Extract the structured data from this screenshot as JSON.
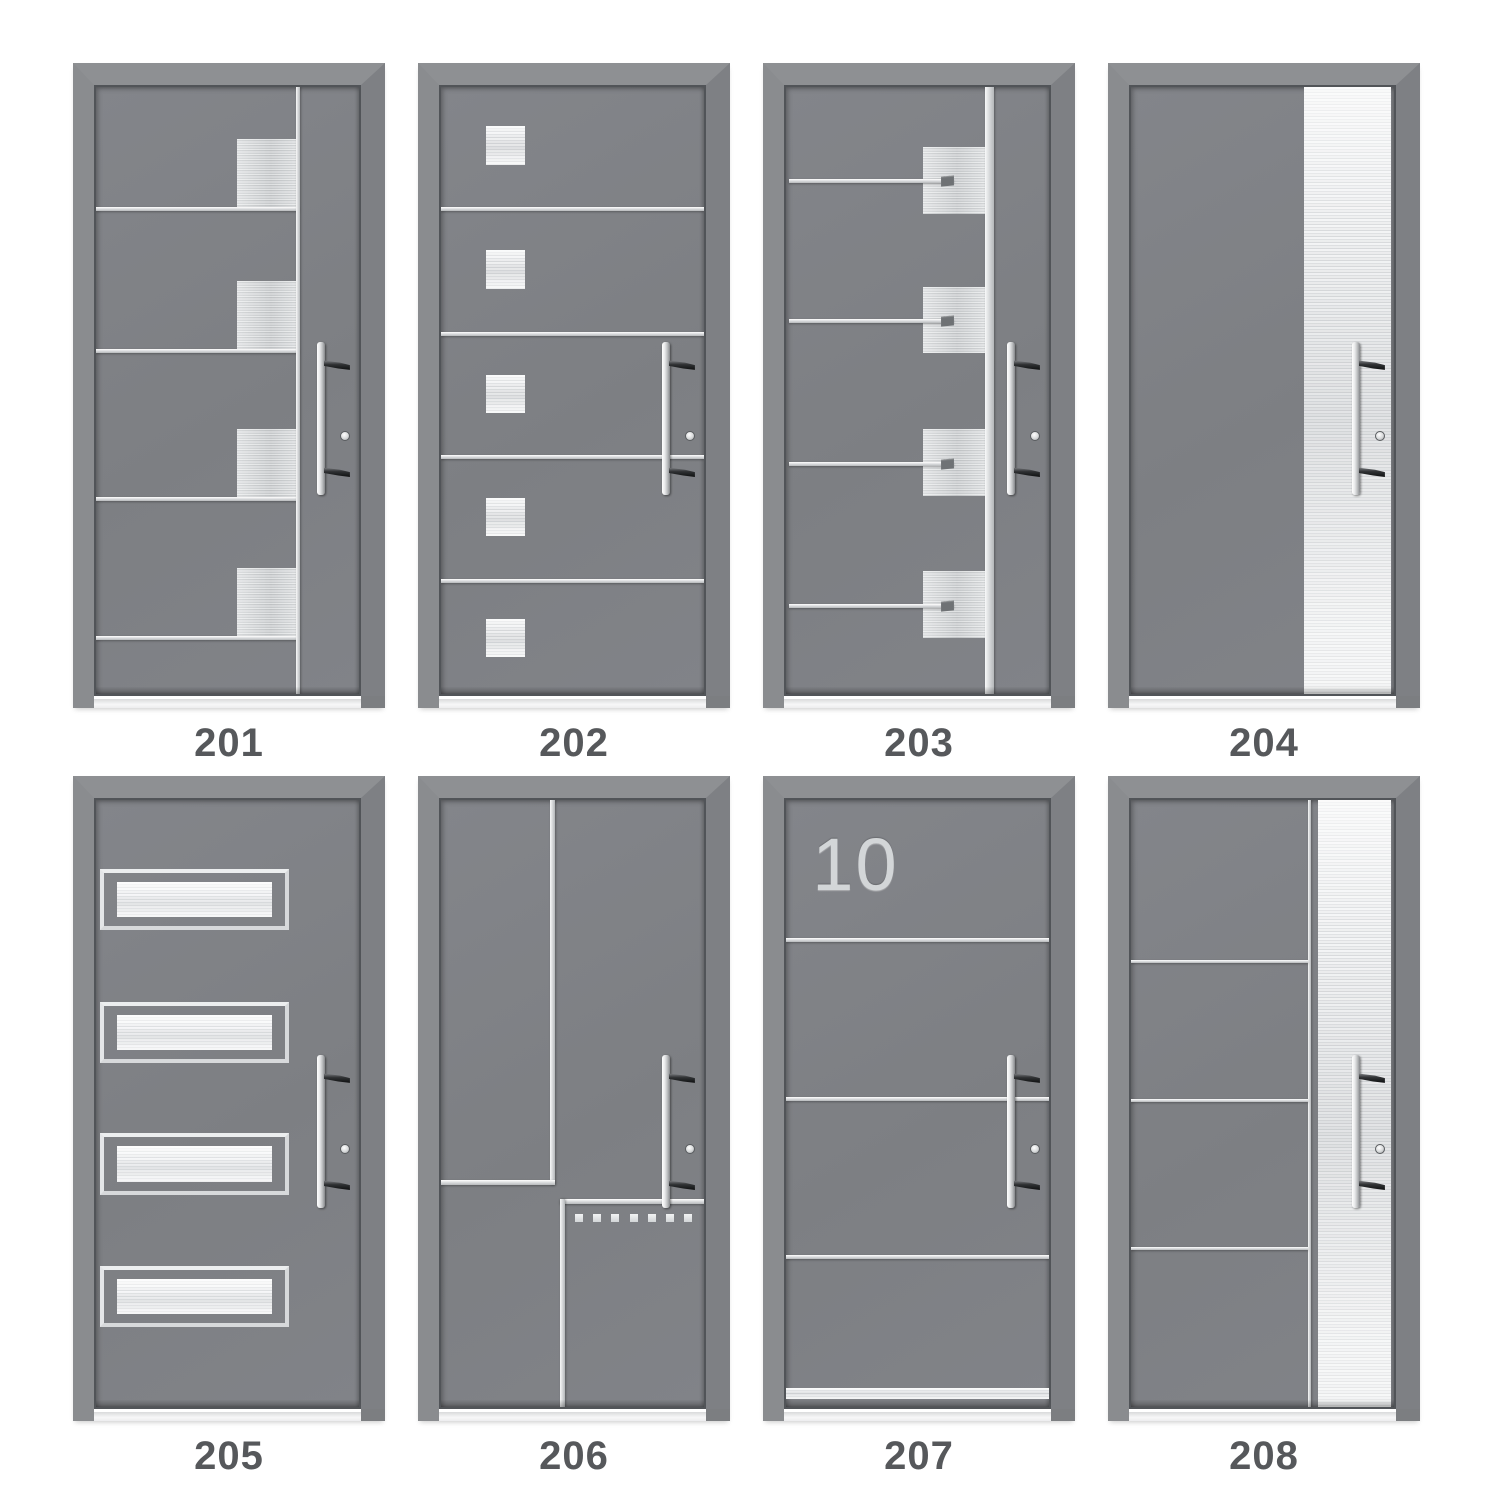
{
  "catalog": {
    "title": "entry-door-design-catalog",
    "doors": [
      {
        "id": "201",
        "label": "201",
        "design": "right-vertical-line-with-four-steel-blocks-and-left-lines"
      },
      {
        "id": "202",
        "label": "202",
        "design": "four-full-width-lines-with-five-steel-squares"
      },
      {
        "id": "203",
        "label": "203",
        "design": "vertical-steel-band-four-blocks-with-pointer-lines"
      },
      {
        "id": "204",
        "label": "204",
        "design": "wide-brushed-steel-panel-right"
      },
      {
        "id": "205",
        "label": "205",
        "design": "four-framed-glass-strips"
      },
      {
        "id": "206",
        "label": "206",
        "design": "geometric-corner-lines-with-dotted-squares"
      },
      {
        "id": "207",
        "label": "207",
        "design": "house-number-three-lines-kick-plate",
        "house_number": "10"
      },
      {
        "id": "208",
        "label": "208",
        "design": "steel-panel-right-with-three-lines-and-divider"
      }
    ],
    "colors": {
      "door_gray": "#7f8185",
      "frame_gray": "#8a8c8f",
      "steel_light": "#eceeef",
      "steel_mid": "#c7cacc",
      "handle_dark": "#2e3032",
      "label_text": "#56585b",
      "background": "#ffffff"
    }
  }
}
